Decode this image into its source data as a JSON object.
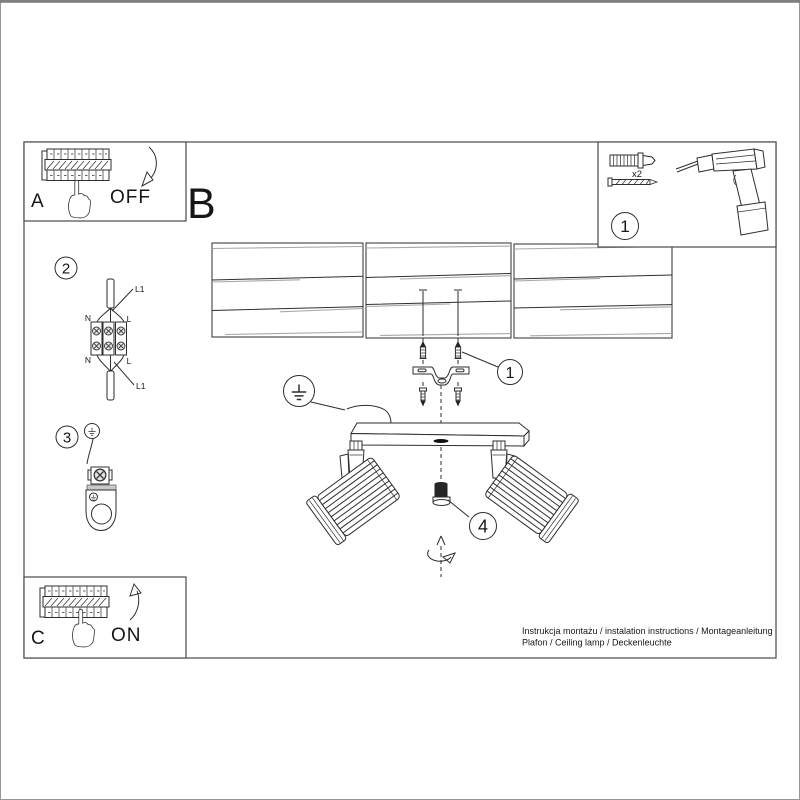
{
  "panel_a": {
    "letter": "A",
    "switch_label": "OFF"
  },
  "panel_c": {
    "letter": "C",
    "switch_label": "ON"
  },
  "section_label_b": "B",
  "tools_panel": {
    "step_number": "1",
    "plug_quantity": "x2"
  },
  "steps": {
    "wiring": {
      "number": "2",
      "l1_top": "L1",
      "n_top": "N",
      "l_top": "L",
      "n_bottom": "N",
      "l_bottom": "L",
      "l1_bottom": "L1"
    },
    "ground": {
      "number": "3"
    },
    "mounting": {
      "number": "1"
    },
    "adjust": {
      "number": "4"
    }
  },
  "footer": {
    "line1": "Instrukcja montażu / instalation instructions / Montageanleitung",
    "line2": "Plafon / Ceiling lamp / Deckenleuchte"
  }
}
